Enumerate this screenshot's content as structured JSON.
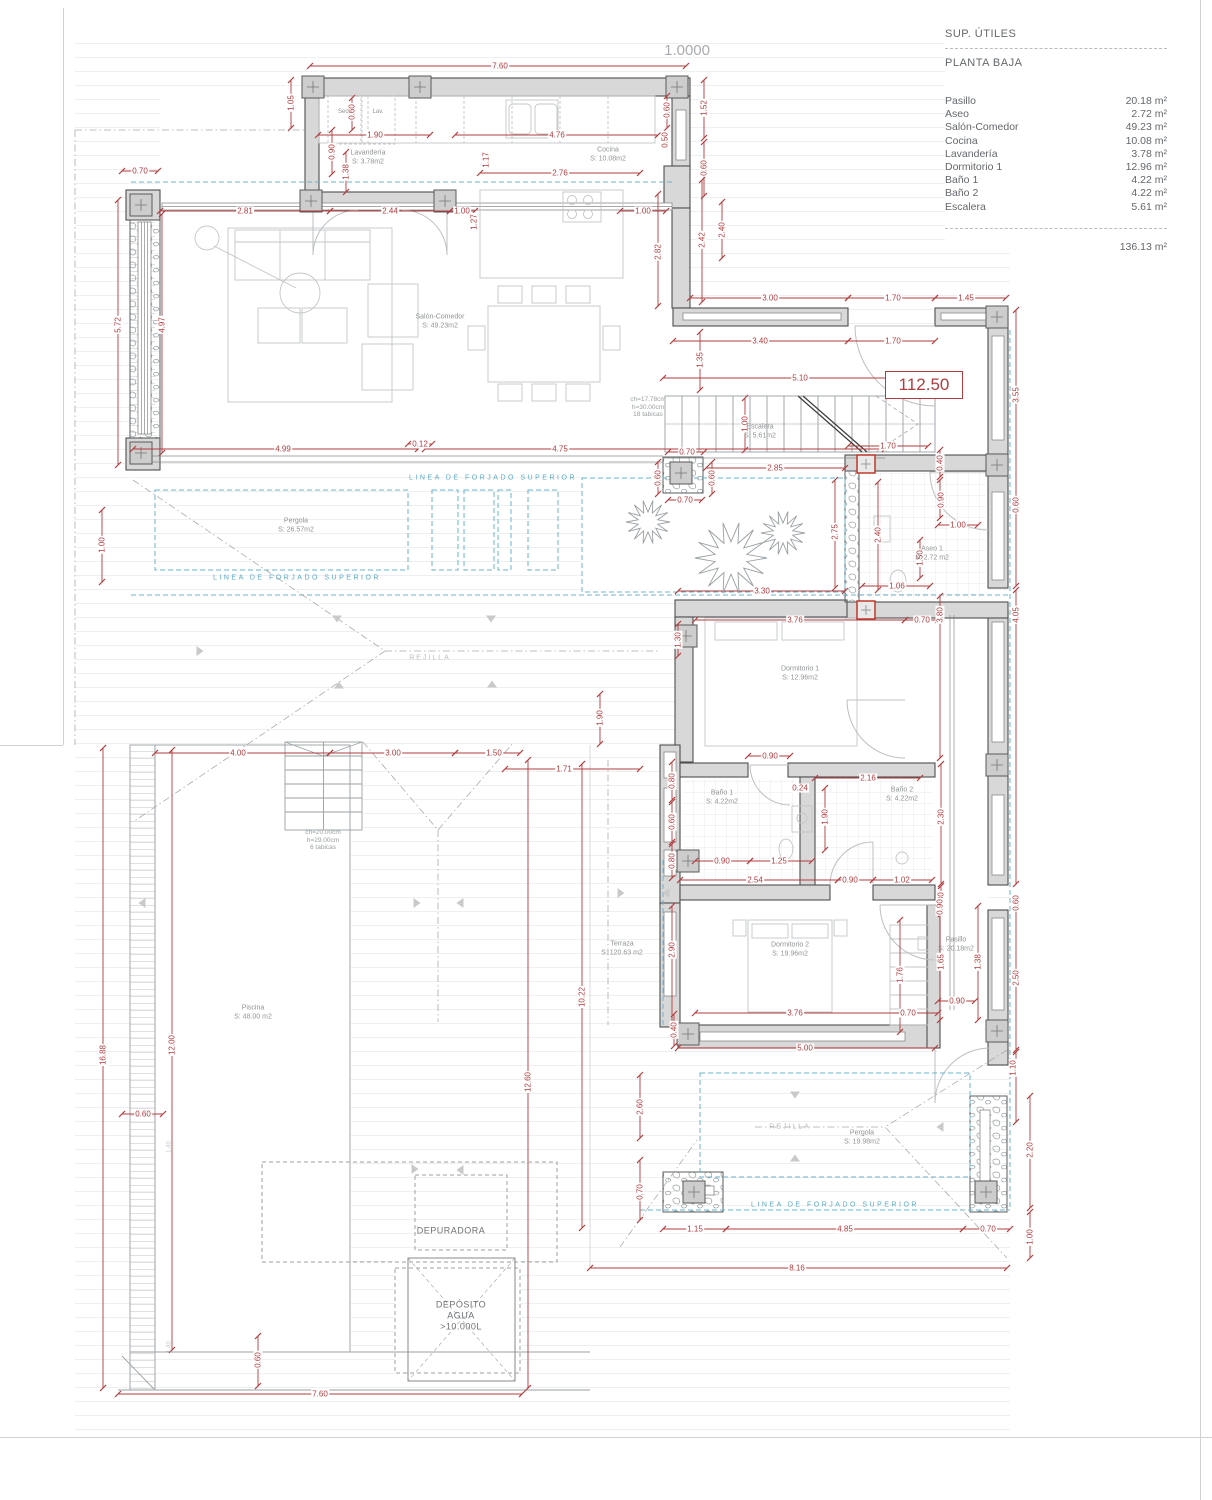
{
  "sheet": {
    "scale_label": "1.0000",
    "level_mark": "112.50"
  },
  "legend": {
    "title": "SUP. ÚTILES",
    "subtitle": "PLANTA BAJA",
    "rows": [
      [
        "Pasillo",
        "20.18 m²"
      ],
      [
        "Aseo",
        "2.72 m²"
      ],
      [
        "Salón-Comedor",
        "49.23 m²"
      ],
      [
        "Cocina",
        "10.08 m²"
      ],
      [
        "Lavandería",
        "3.78 m²"
      ],
      [
        "Dormitorio 1",
        "12.96 m²"
      ],
      [
        "Baño 1",
        "4.22 m²"
      ],
      [
        "Baño 2",
        "4.22 m²"
      ],
      [
        "Escalera",
        "5.61 m²"
      ]
    ],
    "total": "136.13 m²"
  },
  "rooms": [
    {
      "name": "Lavandería",
      "area": "S: 3.78m2",
      "x": 368,
      "y": 158
    },
    {
      "name": "Cocina",
      "area": "S: 10.08m2",
      "x": 608,
      "y": 155
    },
    {
      "name": "Salón-Comedor",
      "area": "S: 49.23m2",
      "x": 440,
      "y": 322
    },
    {
      "name": "Escalera",
      "area": "S: 5.61m2",
      "x": 760,
      "y": 432
    },
    {
      "name": "Pergola",
      "area": "S: 26.57m2",
      "x": 296,
      "y": 526
    },
    {
      "name": "Aseo 1",
      "area": "S: 2.72 m2",
      "x": 932,
      "y": 554
    },
    {
      "name": "Dormitorio 1",
      "area": "S: 12.96m2",
      "x": 800,
      "y": 674
    },
    {
      "name": "Baño 1",
      "area": "S: 4.22m2",
      "x": 722,
      "y": 798
    },
    {
      "name": "Baño 2",
      "area": "S: 4.22m2",
      "x": 902,
      "y": 795
    },
    {
      "name": "Dormitorio 2",
      "area": "S: 19.96m2",
      "x": 790,
      "y": 950
    },
    {
      "name": "Pasillo",
      "area": "S: 20.18m2",
      "x": 956,
      "y": 945
    },
    {
      "name": "Terraza",
      "area": "S: 120.63 m2",
      "x": 622,
      "y": 949
    },
    {
      "name": "Piscina",
      "area": "S: 48.00 m2",
      "x": 253,
      "y": 1013
    },
    {
      "name": "Pergola",
      "area": "S: 19.98m2",
      "x": 862,
      "y": 1138
    }
  ],
  "dims": [
    {
      "t": "7.60",
      "x": 500,
      "y": 66
    },
    {
      "t": "1.05",
      "x": 291,
      "y": 103,
      "v": 1
    },
    {
      "t": "0.60",
      "x": 352,
      "y": 112,
      "v": 1
    },
    {
      "t": "1.90",
      "x": 375,
      "y": 135
    },
    {
      "t": "4.76",
      "x": 557,
      "y": 135
    },
    {
      "t": "0.60",
      "x": 667,
      "y": 110,
      "v": 1
    },
    {
      "t": "1.52",
      "x": 704,
      "y": 108,
      "v": 1
    },
    {
      "t": "0.50",
      "x": 665,
      "y": 140,
      "v": 1
    },
    {
      "t": "0.60",
      "x": 704,
      "y": 168,
      "v": 1
    },
    {
      "t": "2.40",
      "x": 722,
      "y": 230,
      "v": 1
    },
    {
      "t": "0.90",
      "x": 332,
      "y": 152,
      "v": 1
    },
    {
      "t": "1.38",
      "x": 346,
      "y": 172,
      "v": 1
    },
    {
      "t": "0.70",
      "x": 140,
      "y": 171
    },
    {
      "t": "2.81",
      "x": 245,
      "y": 211
    },
    {
      "t": "2.44",
      "x": 390,
      "y": 211
    },
    {
      "t": "1.00",
      "x": 462,
      "y": 211
    },
    {
      "t": "1.17",
      "x": 486,
      "y": 160,
      "v": 1
    },
    {
      "t": "2.76",
      "x": 560,
      "y": 173
    },
    {
      "t": "1.00",
      "x": 643,
      "y": 211
    },
    {
      "t": "1.27",
      "x": 474,
      "y": 222,
      "v": 1
    },
    {
      "t": "2.82",
      "x": 658,
      "y": 252,
      "v": 1
    },
    {
      "t": "2.42",
      "x": 702,
      "y": 240,
      "v": 1
    },
    {
      "t": "3.00",
      "x": 770,
      "y": 298
    },
    {
      "t": "1.70",
      "x": 893,
      "y": 298
    },
    {
      "t": "1.45",
      "x": 966,
      "y": 298
    },
    {
      "t": "3.40",
      "x": 760,
      "y": 341
    },
    {
      "t": "1.70",
      "x": 893,
      "y": 341
    },
    {
      "t": "1.35",
      "x": 700,
      "y": 360,
      "v": 1
    },
    {
      "t": "3.55",
      "x": 1016,
      "y": 395,
      "v": 1
    },
    {
      "t": "5.10",
      "x": 800,
      "y": 378
    },
    {
      "t": "1.00",
      "x": 745,
      "y": 424,
      "v": 1
    },
    {
      "t": "0.12",
      "x": 420,
      "y": 444
    },
    {
      "t": "4.99",
      "x": 283,
      "y": 449
    },
    {
      "t": "4.75",
      "x": 560,
      "y": 449
    },
    {
      "t": "0.70",
      "x": 687,
      "y": 452
    },
    {
      "t": "0.70",
      "x": 685,
      "y": 500
    },
    {
      "t": "2.85",
      "x": 775,
      "y": 468
    },
    {
      "t": "0.60",
      "x": 658,
      "y": 478,
      "v": 1
    },
    {
      "t": "0.60",
      "x": 712,
      "y": 478,
      "v": 1
    },
    {
      "t": "1.70",
      "x": 888,
      "y": 446
    },
    {
      "t": "0.40",
      "x": 940,
      "y": 463,
      "v": 1
    },
    {
      "t": "0.90",
      "x": 941,
      "y": 500,
      "v": 1
    },
    {
      "t": "1.00",
      "x": 958,
      "y": 525
    },
    {
      "t": "2.40",
      "x": 878,
      "y": 535,
      "v": 1
    },
    {
      "t": "1.50",
      "x": 920,
      "y": 558,
      "v": 1
    },
    {
      "t": "1.06",
      "x": 897,
      "y": 586
    },
    {
      "t": "2.75",
      "x": 835,
      "y": 532,
      "v": 1
    },
    {
      "t": "3.30",
      "x": 762,
      "y": 591
    },
    {
      "t": "3.80",
      "x": 940,
      "y": 615,
      "v": 1
    },
    {
      "t": "4.05",
      "x": 1016,
      "y": 615,
      "v": 1
    },
    {
      "t": "0.60",
      "x": 1016,
      "y": 505,
      "v": 1
    },
    {
      "t": "5.72",
      "x": 118,
      "y": 325,
      "v": 1
    },
    {
      "t": "4.97",
      "x": 162,
      "y": 325,
      "v": 1
    },
    {
      "t": "1.00",
      "x": 102,
      "y": 545,
      "v": 1
    },
    {
      "t": "3.76",
      "x": 795,
      "y": 620
    },
    {
      "t": "0.70",
      "x": 922,
      "y": 620
    },
    {
      "t": "1.30",
      "x": 678,
      "y": 640,
      "v": 1
    },
    {
      "t": "1.90",
      "x": 600,
      "y": 718,
      "v": 1
    },
    {
      "t": "0.80",
      "x": 672,
      "y": 781,
      "v": 1
    },
    {
      "t": "0.60",
      "x": 672,
      "y": 822,
      "v": 1
    },
    {
      "t": "0.80",
      "x": 672,
      "y": 861,
      "v": 1
    },
    {
      "t": "0.90",
      "x": 770,
      "y": 756
    },
    {
      "t": "0.24",
      "x": 800,
      "y": 788
    },
    {
      "t": "2.16",
      "x": 868,
      "y": 778
    },
    {
      "t": "1.90",
      "x": 825,
      "y": 817,
      "v": 1
    },
    {
      "t": "2.30",
      "x": 941,
      "y": 817,
      "v": 1
    },
    {
      "t": "0.90",
      "x": 722,
      "y": 861
    },
    {
      "t": "1.25",
      "x": 779,
      "y": 861
    },
    {
      "t": "2.54",
      "x": 755,
      "y": 880
    },
    {
      "t": "0.90",
      "x": 850,
      "y": 880
    },
    {
      "t": "1.02",
      "x": 902,
      "y": 880
    },
    {
      "t": "0.80",
      "x": 941,
      "y": 900,
      "v": 1
    },
    {
      "t": "2.90",
      "x": 672,
      "y": 950,
      "v": 1
    },
    {
      "t": "0.90",
      "x": 940,
      "y": 907,
      "v": 1
    },
    {
      "t": "0.60",
      "x": 1016,
      "y": 903,
      "v": 1
    },
    {
      "t": "1.65",
      "x": 941,
      "y": 962,
      "v": 1
    },
    {
      "t": "1.76",
      "x": 900,
      "y": 975,
      "v": 1
    },
    {
      "t": "1.38",
      "x": 978,
      "y": 962,
      "v": 1
    },
    {
      "t": "2.50",
      "x": 1016,
      "y": 978,
      "v": 1
    },
    {
      "t": "0.90",
      "x": 957,
      "y": 1001
    },
    {
      "t": "3.76",
      "x": 795,
      "y": 1013
    },
    {
      "t": "0.70",
      "x": 908,
      "y": 1013
    },
    {
      "t": "5.00",
      "x": 805,
      "y": 1048
    },
    {
      "t": "0.40",
      "x": 674,
      "y": 1030,
      "v": 1
    },
    {
      "t": "4.00",
      "x": 238,
      "y": 753
    },
    {
      "t": "3.00",
      "x": 393,
      "y": 753
    },
    {
      "t": "1.50",
      "x": 494,
      "y": 753
    },
    {
      "t": "1.71",
      "x": 564,
      "y": 769
    },
    {
      "t": "16.88",
      "x": 103,
      "y": 1055,
      "v": 1
    },
    {
      "t": "12.00",
      "x": 172,
      "y": 1045,
      "v": 1
    },
    {
      "t": "12.60",
      "x": 528,
      "y": 1082,
      "v": 1
    },
    {
      "t": "10.22",
      "x": 582,
      "y": 997,
      "v": 1
    },
    {
      "t": "0.60",
      "x": 143,
      "y": 1114
    },
    {
      "t": "0.70",
      "x": 640,
      "y": 1192,
      "v": 1
    },
    {
      "t": "2.60",
      "x": 640,
      "y": 1107,
      "v": 1
    },
    {
      "t": "0.60",
      "x": 258,
      "y": 1360,
      "v": 1
    },
    {
      "t": "7.60",
      "x": 320,
      "y": 1394
    },
    {
      "t": "8.16",
      "x": 797,
      "y": 1268
    },
    {
      "t": "1.15",
      "x": 695,
      "y": 1229
    },
    {
      "t": "4.85",
      "x": 845,
      "y": 1229
    },
    {
      "t": "0.70",
      "x": 988,
      "y": 1229
    },
    {
      "t": "1.10",
      "x": 1013,
      "y": 1068,
      "v": 1
    },
    {
      "t": "2.20",
      "x": 1030,
      "y": 1150,
      "v": 1
    },
    {
      "t": "1.00",
      "x": 1030,
      "y": 1237,
      "v": 1
    }
  ],
  "notes": [
    {
      "lines": [
        "ch=17.78cm",
        "h=30.00cm",
        "18 tabicas"
      ],
      "x": 648,
      "y": 407
    },
    {
      "lines": [
        "ch=20.00cm",
        "h=29.00cm",
        "6 tabicas"
      ],
      "x": 323,
      "y": 840
    },
    {
      "lines": [
        "1.40"
      ],
      "x": 170,
      "y": 1147,
      "tiny": 1
    },
    {
      "lines": [
        "1.40"
      ],
      "x": 170,
      "y": 1347,
      "tiny": 1
    },
    {
      "lines": [
        "DEPURADORA"
      ],
      "x": 451,
      "y": 1231,
      "dark": 1
    },
    {
      "lines": [
        "DEPÓSITO",
        "AGUA",
        ">10.000L"
      ],
      "x": 461,
      "y": 1316,
      "dark": 1
    }
  ],
  "blue_labels": [
    {
      "t": "LINEA DE FORJADO SUPERIOR",
      "x": 493,
      "y": 478
    },
    {
      "t": "LINEA DE FORJADO SUPERIOR",
      "x": 297,
      "y": 578
    },
    {
      "t": "LINEA DE FORJADO SUPERIOR",
      "x": 835,
      "y": 1205
    }
  ],
  "grey_labels": [
    {
      "t": "REJILLA",
      "x": 430,
      "y": 658
    },
    {
      "t": "REJILLA",
      "x": 790,
      "y": 1127
    },
    {
      "t": "Sec.",
      "x": 344,
      "y": 112,
      "s": 6
    },
    {
      "t": "Lav.",
      "x": 378,
      "y": 112,
      "s": 6
    }
  ],
  "arrows": [
    {
      "d": "d",
      "x": 337,
      "y": 619
    },
    {
      "d": "d",
      "x": 491,
      "y": 619
    },
    {
      "d": "r",
      "x": 200,
      "y": 651
    },
    {
      "d": "u",
      "x": 339,
      "y": 685
    },
    {
      "d": "u",
      "x": 492,
      "y": 684
    },
    {
      "d": "l",
      "x": 142,
      "y": 903
    },
    {
      "d": "r",
      "x": 417,
      "y": 903
    },
    {
      "d": "l",
      "x": 460,
      "y": 903
    },
    {
      "d": "r",
      "x": 415,
      "y": 1169
    },
    {
      "d": "l",
      "x": 460,
      "y": 1170
    },
    {
      "d": "r",
      "x": 621,
      "y": 893
    },
    {
      "d": "l",
      "x": 666,
      "y": 893
    },
    {
      "d": "d",
      "x": 795,
      "y": 1095
    },
    {
      "d": "u",
      "x": 795,
      "y": 1158
    },
    {
      "d": "l",
      "x": 940,
      "y": 1127
    }
  ]
}
